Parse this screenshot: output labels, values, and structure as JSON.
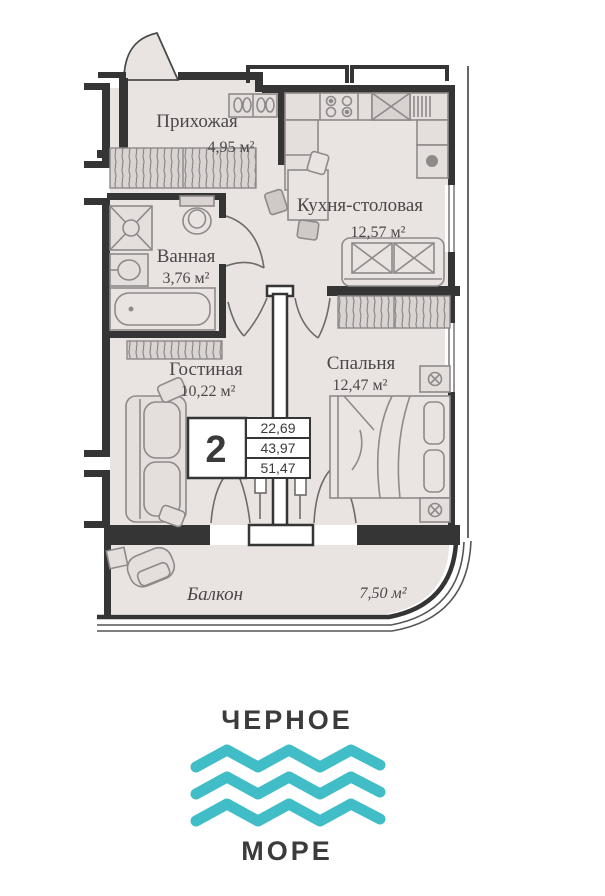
{
  "floor_plan": {
    "rooms": [
      {
        "name": "Прихожая",
        "area": "4,95 м²"
      },
      {
        "name": "Кухня-столовая",
        "area": "12,57 м²"
      },
      {
        "name": "Ванная",
        "area": "3,76 м²"
      },
      {
        "name": "Гостиная",
        "area": "10,22 м²"
      },
      {
        "name": "Спальня",
        "area": "12,47 м²"
      },
      {
        "name": "Балкон",
        "area": "7,50 м²"
      }
    ],
    "summary_badge": {
      "rooms_count": "2",
      "values": [
        "22,69",
        "43,97",
        "51,47"
      ]
    }
  },
  "logo": {
    "top_text": "ЧЕРНОЕ",
    "bottom_text": "МОРЕ"
  },
  "colors": {
    "wall": "#353535",
    "floor": "#e9e3e2",
    "furniture_outline": "#8f8a8a",
    "hatch_fill": "#d9d3d2",
    "label_text": "#4c4747",
    "logo_text": "#3b3b3b",
    "wave_teal": "#41bdc7"
  }
}
